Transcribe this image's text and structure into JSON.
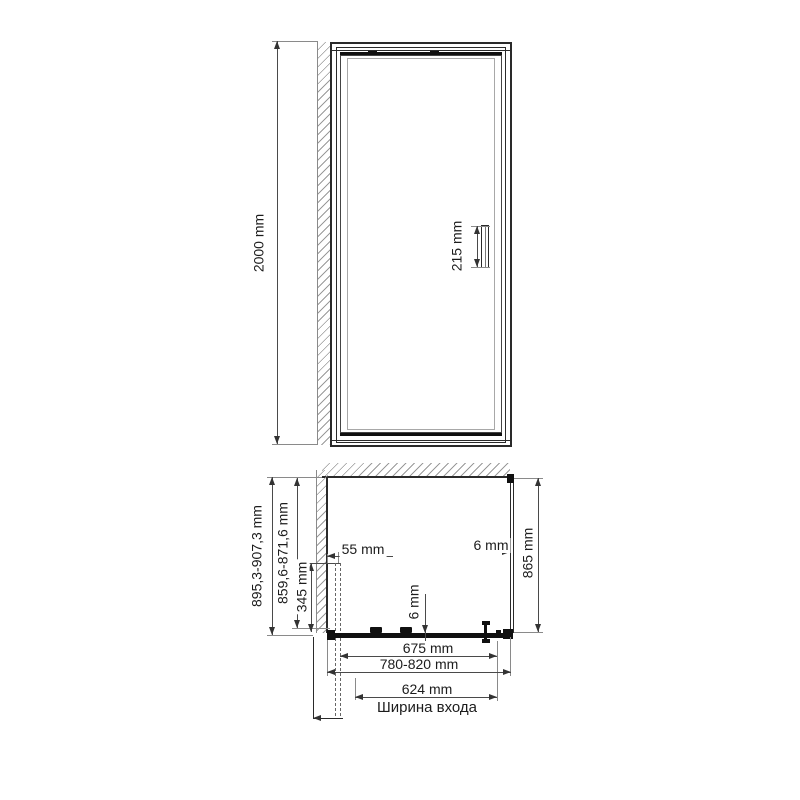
{
  "drawing": {
    "title_hint": "shower door technical drawing",
    "front_view": {
      "total_height_label": "2000 mm",
      "handle_height_label": "215 mm"
    },
    "plan_view": {
      "overall_depth_range_label": "895,3-907,3 mm",
      "inner_depth_range_label": "859,6-871,6 mm",
      "side_offset_label": "345 mm",
      "wall_profile_width_label": "55 mm",
      "side_glass_thickness_label": "6 mm",
      "side_panel_depth_label": "865 mm",
      "door_glass_thickness_label": "6 mm",
      "fixed_part_width_label": "675 mm",
      "overall_width_range_label": "780-820 mm",
      "entrance_width_label": "624 mm",
      "entrance_caption": "Ширина входа"
    },
    "colors": {
      "line": "#2a2a2a",
      "dimension": "#4a4a4a",
      "hatch": "#9a9a9a",
      "background": "#ffffff"
    }
  }
}
